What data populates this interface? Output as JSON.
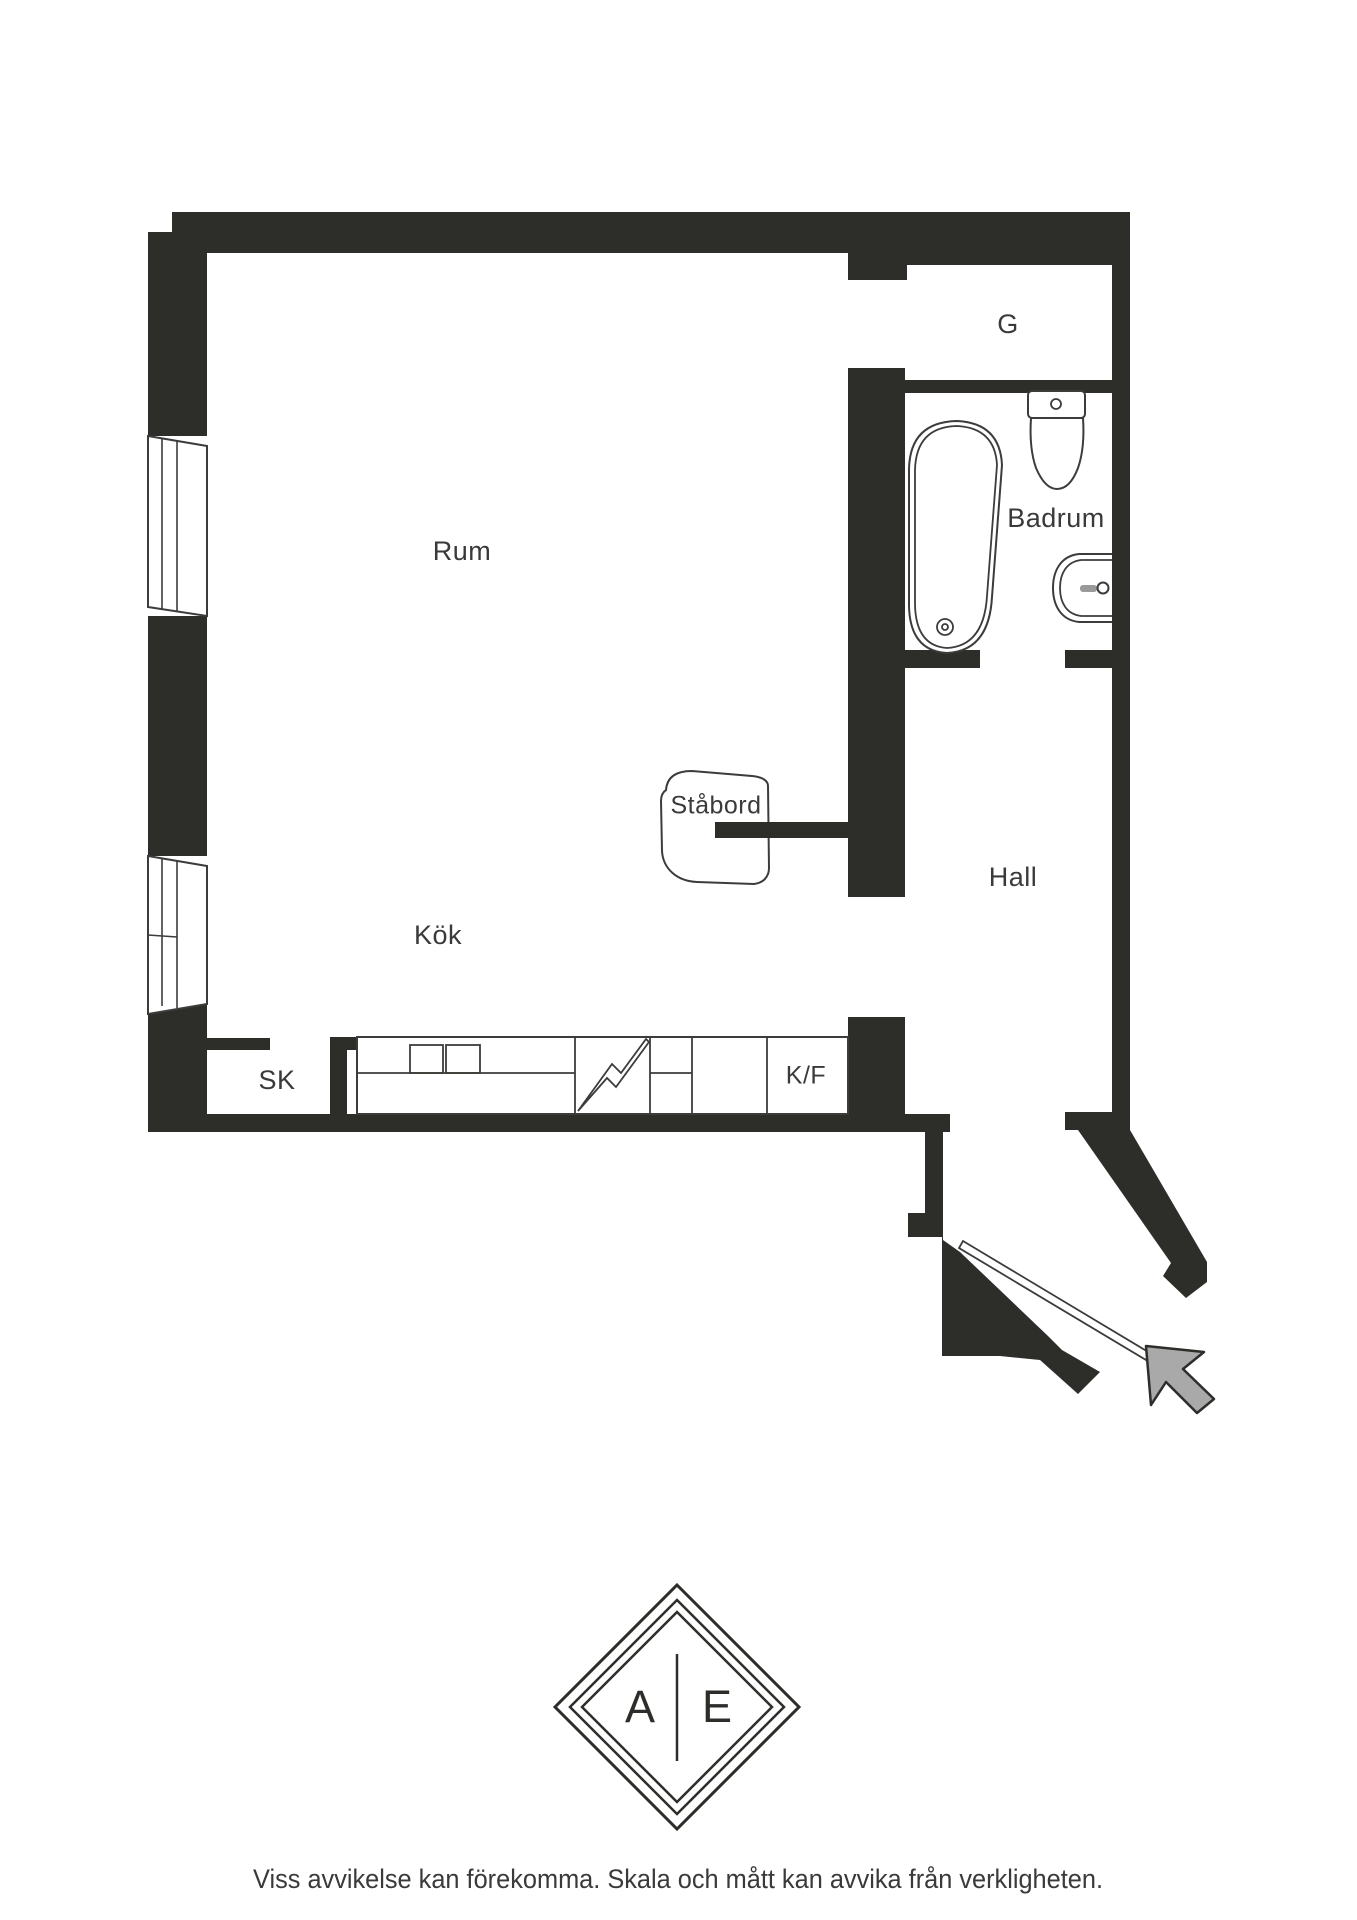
{
  "theme": {
    "wall_color": "#2d2d2a",
    "line_color": "#3c3c3a",
    "label_color": "#3a3a3a",
    "arrow_color": "#a9a9a9"
  },
  "floorplan": {
    "labels": {
      "rum": "Rum",
      "kok": "Kök",
      "badrum": "Badrum",
      "hall": "Hall",
      "garderob": "G",
      "sk": "SK",
      "kf": "K/F",
      "stabord": "Ståbord"
    }
  },
  "logo": {
    "letter_left": "A",
    "letter_right": "E"
  },
  "disclaimer": "Viss avvikelse kan förekomma. Skala och mått kan avvika från verkligheten."
}
